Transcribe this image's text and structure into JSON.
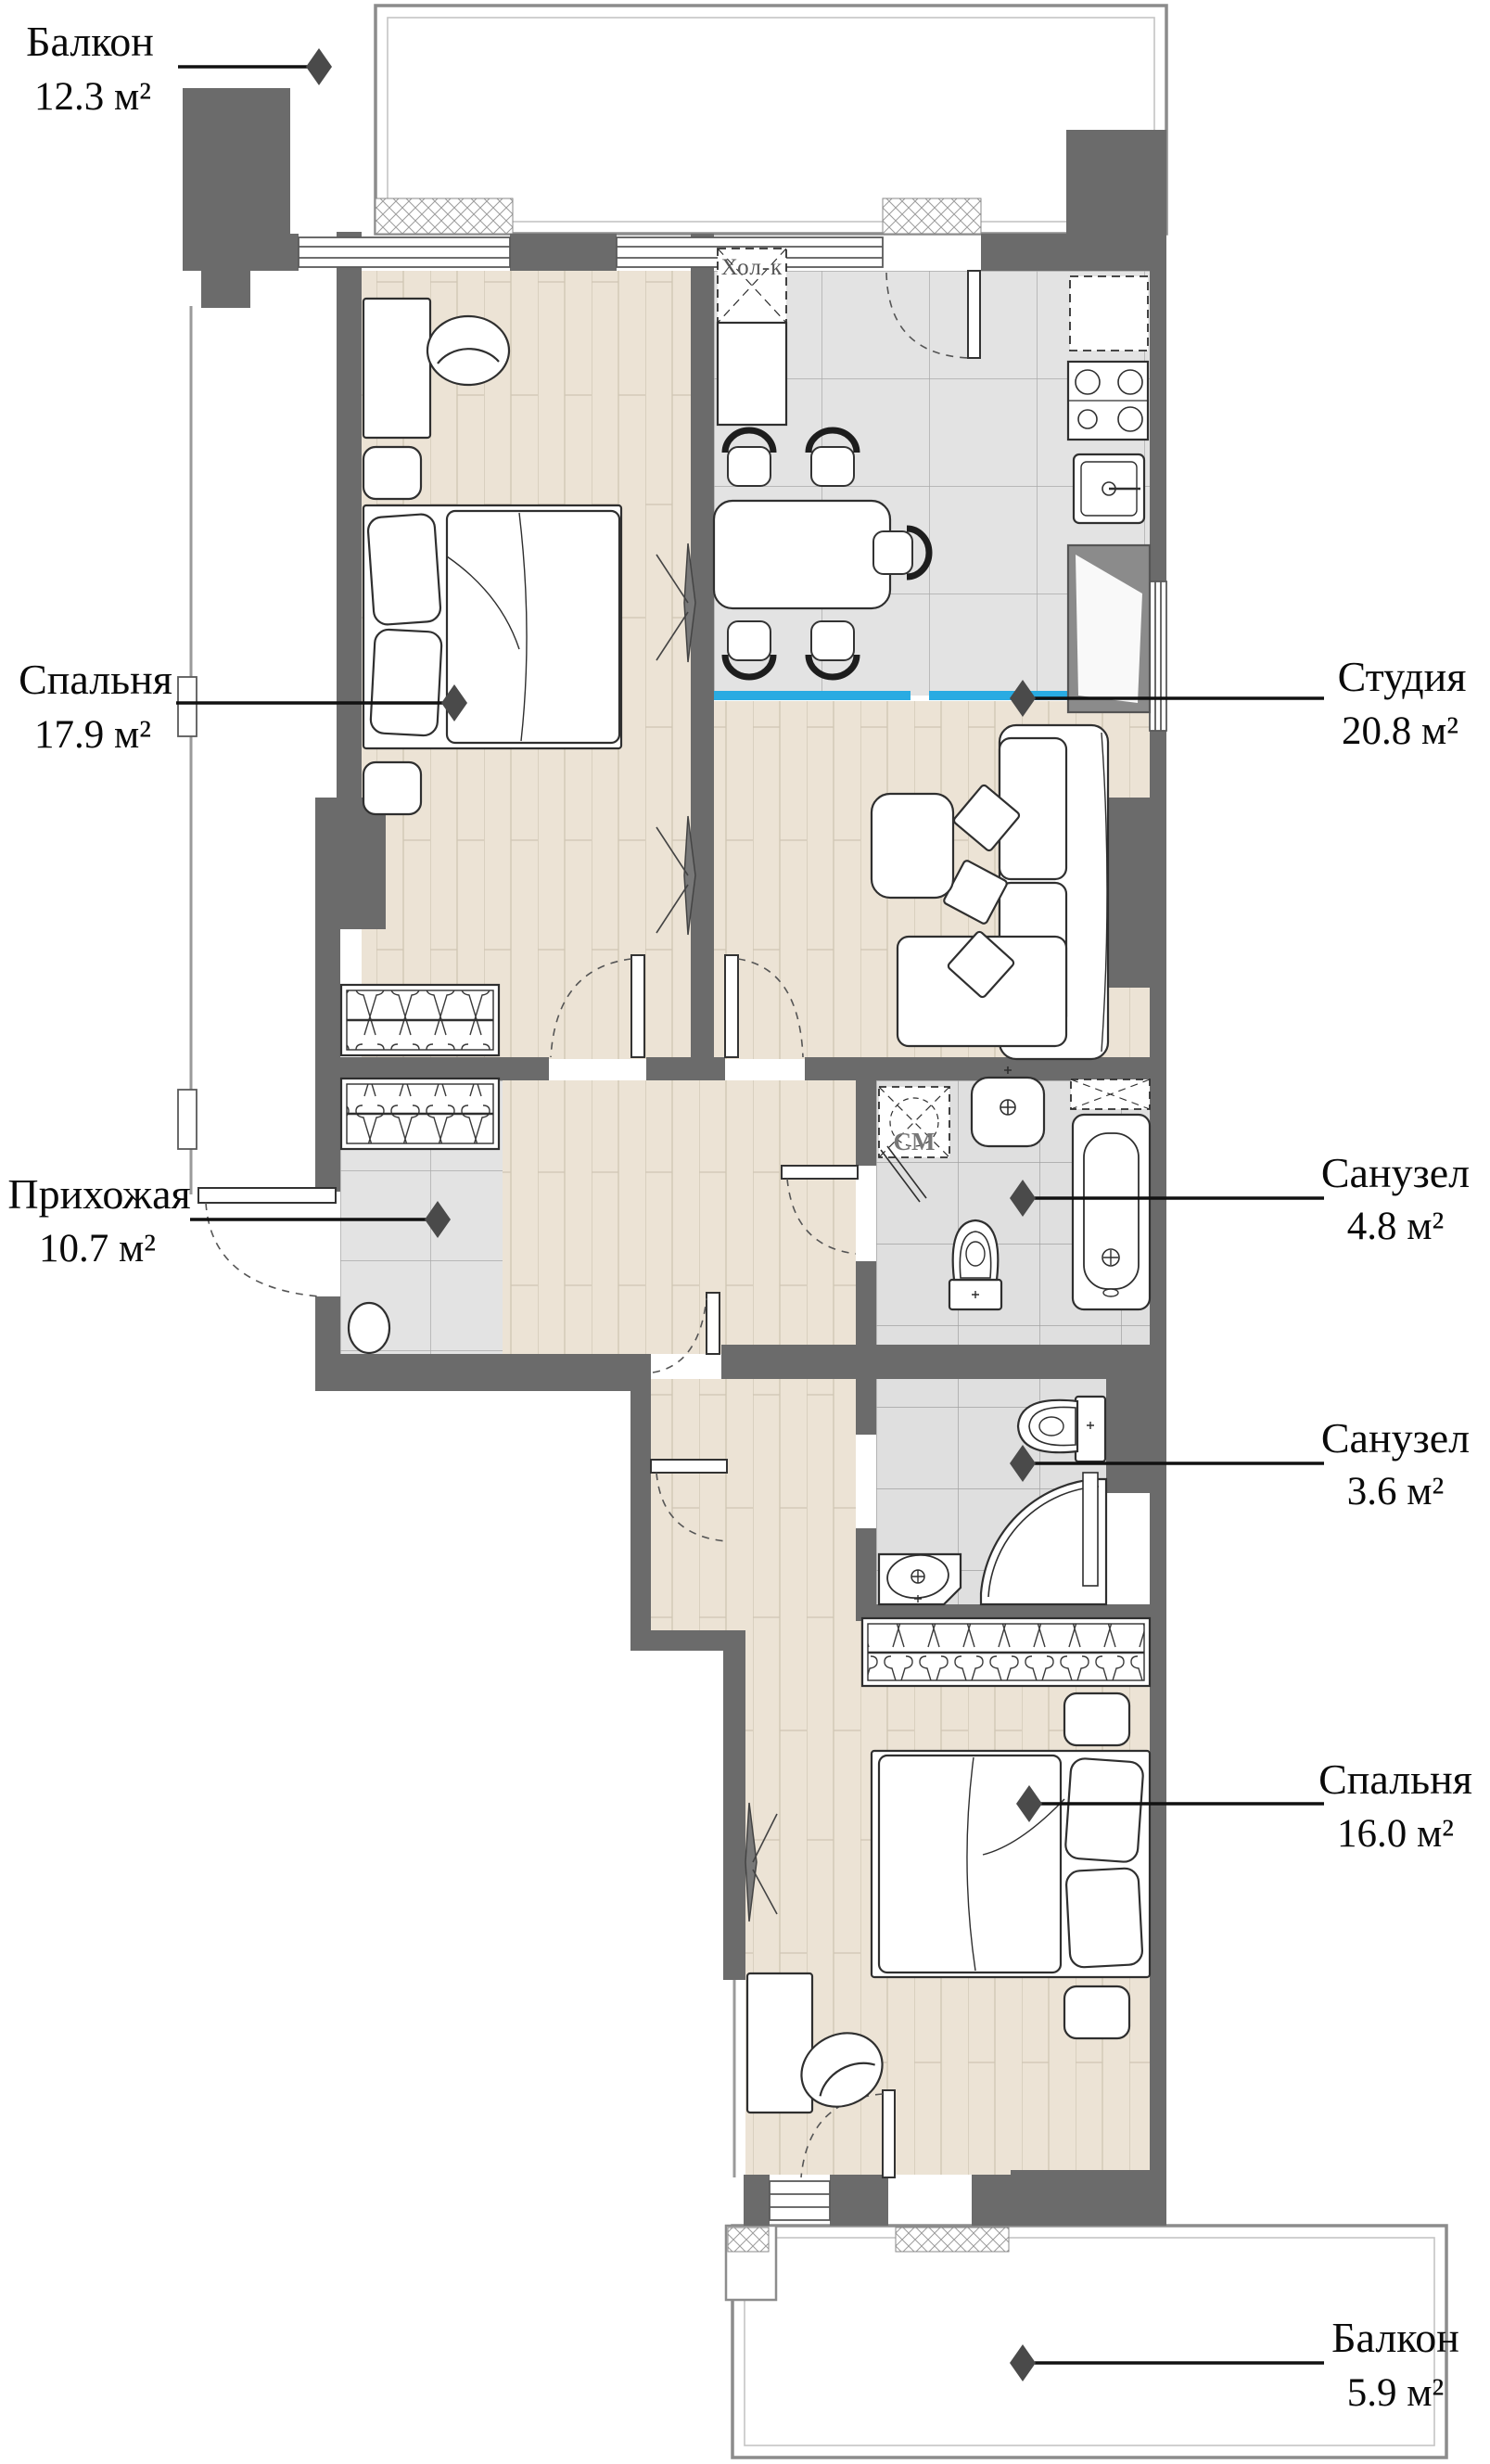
{
  "document": {
    "type": "apartment-floor-plan",
    "language": "ru"
  },
  "rooms": [
    {
      "id": "balcony-top",
      "name": "Балкон",
      "area": "12.3 м²",
      "area_value": 12.3,
      "floor": "open",
      "label_side": "left"
    },
    {
      "id": "bedroom-1",
      "name": "Спальня",
      "area": "17.9 м²",
      "area_value": 17.9,
      "floor": "wood",
      "label_side": "left"
    },
    {
      "id": "studio",
      "name": "Студия",
      "area": "20.8 м²",
      "area_value": 20.8,
      "floor": "tile+wood",
      "label_side": "right"
    },
    {
      "id": "hallway",
      "name": "Прихожая",
      "area": "10.7 м²",
      "area_value": 10.7,
      "floor": "tile",
      "label_side": "left"
    },
    {
      "id": "bathroom-1",
      "name": "Санузел",
      "area": "4.8 м²",
      "area_value": 4.8,
      "floor": "tile",
      "label_side": "right"
    },
    {
      "id": "bathroom-2",
      "name": "Санузел",
      "area": "3.6 м²",
      "area_value": 3.6,
      "floor": "tile",
      "label_side": "right"
    },
    {
      "id": "bedroom-2",
      "name": "Спальня",
      "area": "16.0 м²",
      "area_value": 16.0,
      "floor": "wood",
      "label_side": "right"
    },
    {
      "id": "balcony-bottom",
      "name": "Балкон",
      "area": "5.9 м²",
      "area_value": 5.9,
      "floor": "open",
      "label_side": "right"
    }
  ],
  "fixtures": {
    "fridge_label": "Хол-к",
    "washer_label": "СМ"
  },
  "colors": {
    "wall": "#6b6b6b",
    "wall_light": "#8b8b8b",
    "wood_floor": "#ece3d5",
    "wood_seam": "#cfc5b3",
    "tile_floor": "#e3e3e3",
    "bath_tile": "#dfdfdf",
    "tile_grid": "#a9a9a9",
    "accent_blue": "#29abe2",
    "furniture_outline": "#2f2f2f",
    "marker": "#4a4a4a",
    "label_text": "#0a0a0a"
  }
}
